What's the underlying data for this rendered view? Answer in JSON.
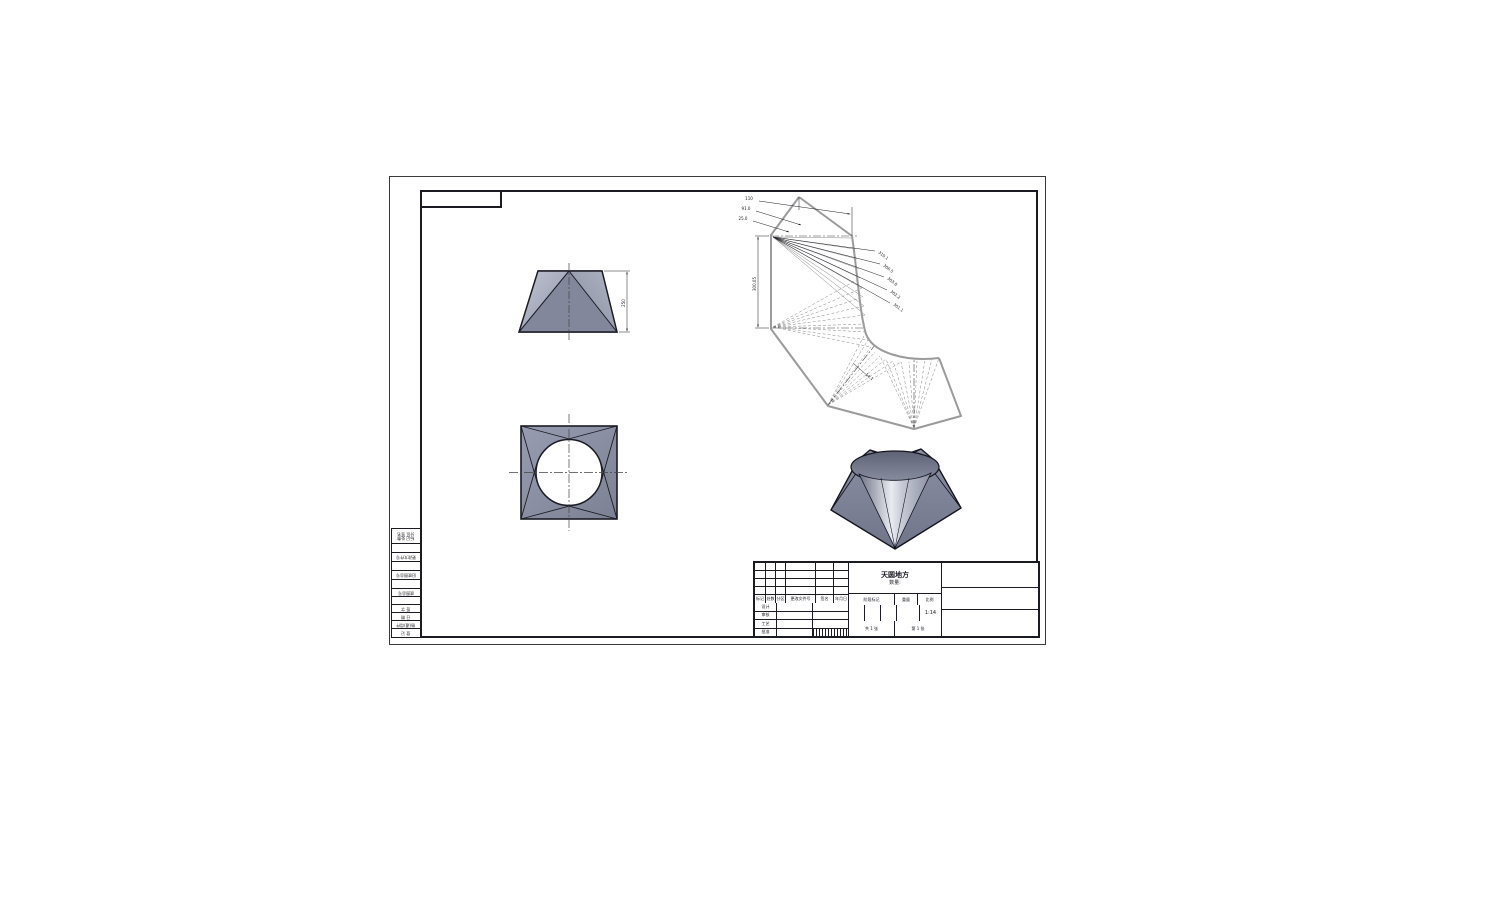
{
  "page": {
    "type": "cad-drawing-sheet",
    "background": "#ffffff"
  },
  "colors": {
    "edge": "#1b1b24",
    "model_fill": "#8e93a6",
    "model_light": "#c2c6d4",
    "pattern_outline": "#9b9b9b",
    "sheet_border": "#3a3a3a"
  },
  "views": {
    "front": {
      "height_dim": "250"
    },
    "development": {
      "vertical_dim": "300.05",
      "leader_dims": [
        "110",
        "91.0",
        "25.0"
      ],
      "chord_dims": [
        "310.1",
        "306.5",
        "303.8",
        "302.2",
        "301.1",
        "14.1"
      ]
    }
  },
  "title_block": {
    "part_name_line1": "天圆地方",
    "part_name_line2": "数量:",
    "rev_header": [
      "标记",
      "处数",
      "分区",
      "更改文件号",
      "签名",
      "年月日"
    ],
    "sign_labels": [
      "设计",
      "审核",
      "工艺",
      "批准"
    ],
    "stage_label": "阶段标记",
    "weight_label": "重量",
    "scale_label": "比例",
    "scale_value": "1:14",
    "sheet_total": "共 1 张",
    "sheet_index": "第 1 张"
  },
  "left_strip": {
    "cells": [
      "标记 处数\n分区 签名",
      "",
      "更改文件号",
      "",
      "旧底图总号",
      "",
      "底图总号",
      "",
      "签 字",
      "日 期",
      "借(通)用件",
      "登 记"
    ]
  }
}
